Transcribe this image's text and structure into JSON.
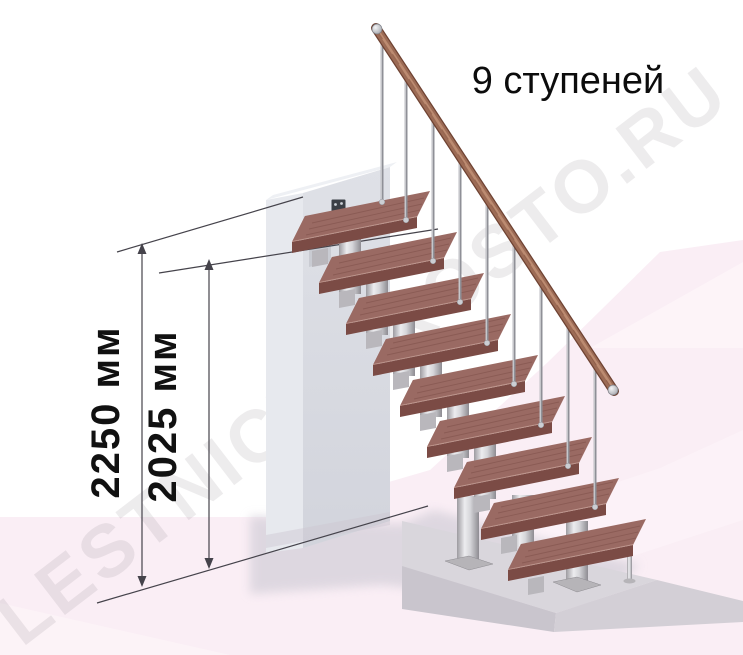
{
  "illustration": {
    "title": "9 ступеней",
    "watermark": "LESTNICY-PROSTO.RU",
    "steps_count": 9,
    "dimensions": [
      {
        "id": "total-height",
        "label": "2250 мм"
      },
      {
        "id": "top-step-height",
        "label": "2025 мм"
      }
    ]
  },
  "colors": {
    "wood_top": "#9a6a63",
    "wood_front": "#7b4b45",
    "wood_side": "#8a5750",
    "rail_wood": "#9c6b55",
    "rail_dark": "#6e4232",
    "rail_light": "#c49478",
    "metal_mid": "#aaa8ad",
    "metal_light": "#ebebee",
    "metal_dark": "#939196",
    "dim_line": "#45434b",
    "text": "#0c0c0c",
    "floor_pink": "#faeef5",
    "wall_gray": "#d9dbe1",
    "platform_gray": "#d9d6dc"
  }
}
